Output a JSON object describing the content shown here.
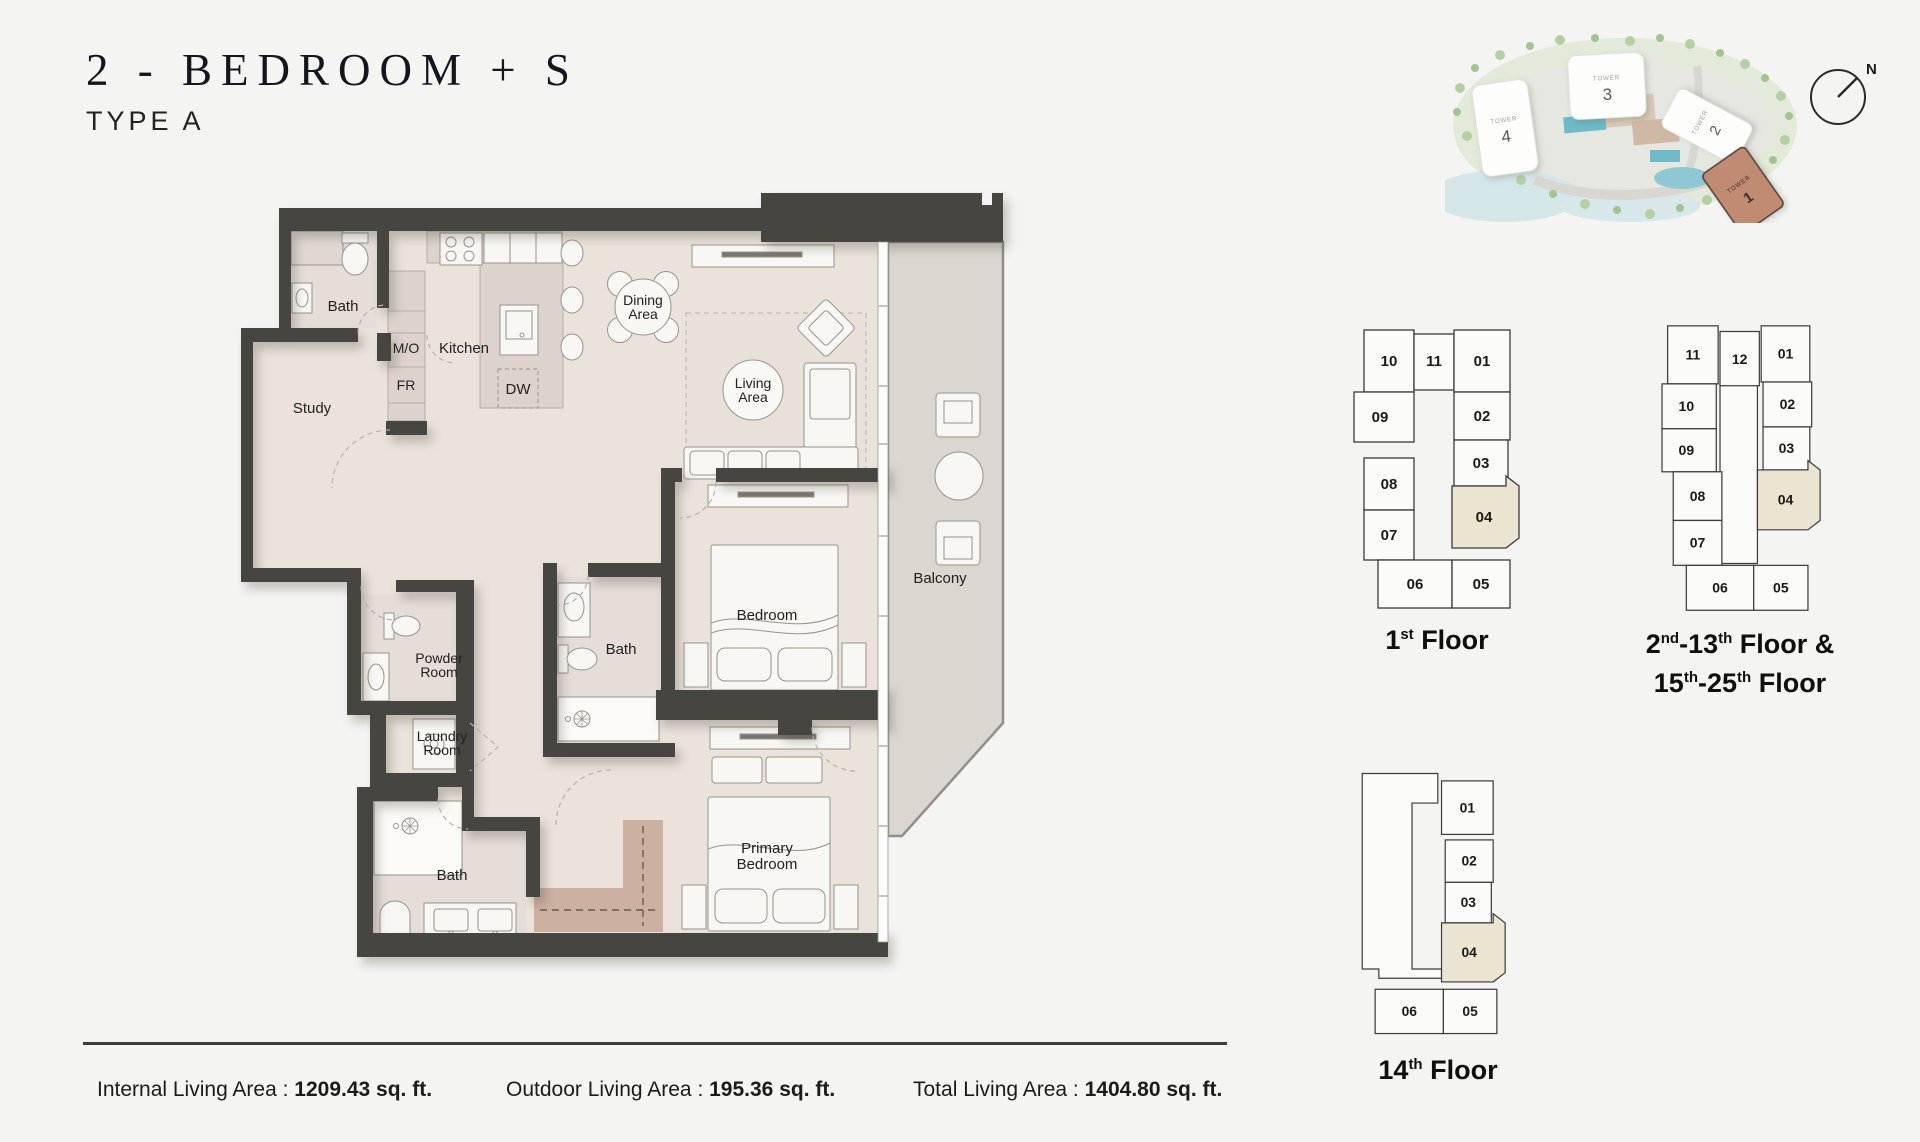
{
  "header": {
    "title": "2 - BEDROOM + S",
    "subtitle": "TYPE A"
  },
  "plan": {
    "labels": {
      "bath1": "Bath",
      "study": "Study",
      "mo": "M/O",
      "fr": "FR",
      "kitchen": "Kitchen",
      "dw": "DW",
      "dining1": "Dining",
      "dining2": "Area",
      "living1": "Living",
      "living2": "Area",
      "bedroom": "Bedroom",
      "bath2": "Bath",
      "balcony": "Balcony",
      "powder1": "Powder",
      "powder2": "Room",
      "laundry1": "Laundry",
      "laundry2": "Room",
      "bath3": "Bath",
      "primary1": "Primary",
      "primary2": "Bedroom"
    }
  },
  "site": {
    "towers": [
      {
        "name": "TOWER",
        "num": "4"
      },
      {
        "name": "TOWER",
        "num": "3"
      },
      {
        "name": "TOWER",
        "num": "2"
      },
      {
        "name": "TOWER",
        "num": "1"
      }
    ],
    "compass": "N"
  },
  "plates": {
    "first": {
      "units": [
        "10",
        "11",
        "01",
        "09",
        "02",
        "03",
        "08",
        "04",
        "07",
        "06",
        "05"
      ],
      "caption": [
        {
          "t": "1",
          "sup": "st"
        },
        {
          "t": " Floor",
          "sup": ""
        }
      ]
    },
    "typical": {
      "units": [
        "11",
        "12",
        "01",
        "10",
        "02",
        "09",
        "03",
        "08",
        "04",
        "07",
        "06",
        "05"
      ],
      "caption_line1": [
        {
          "t": "2",
          "sup": "nd"
        },
        {
          "t": "-13",
          "sup": "th"
        },
        {
          "t": " Floor &",
          "sup": ""
        }
      ],
      "caption_line2": [
        {
          "t": "15",
          "sup": "th"
        },
        {
          "t": "-25",
          "sup": "th"
        },
        {
          "t": " Floor",
          "sup": ""
        }
      ]
    },
    "fourteenth": {
      "units": [
        "01",
        "02",
        "03",
        "04",
        "06",
        "05"
      ],
      "caption": [
        {
          "t": "14",
          "sup": "th"
        },
        {
          "t": " Floor",
          "sup": ""
        }
      ]
    }
  },
  "stats": {
    "items": [
      {
        "label": "Internal Living Area : ",
        "value": "1209.43 sq. ft."
      },
      {
        "label": "Outdoor Living Area : ",
        "value": "195.36 sq. ft."
      },
      {
        "label": "Total Living Area : ",
        "value": "1404.80 sq. ft."
      }
    ]
  },
  "colors": {
    "wall": "#464540",
    "floor": "#ebe3da",
    "counter": "#ddd2cc",
    "balcony": "#dbd6cf",
    "highlight_unit": "#eae4d0",
    "tower1": "#c08a73"
  }
}
